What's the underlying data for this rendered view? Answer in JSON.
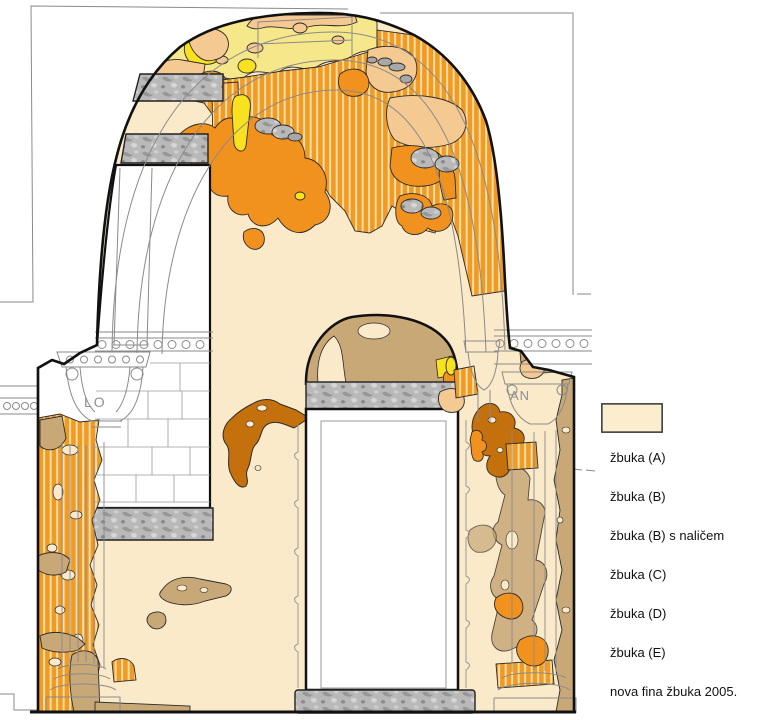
{
  "drawing": {
    "inscriptions": {
      "left_capital": "LO",
      "right_capital": "AN"
    }
  },
  "palette": {
    "kamen_gray": "#B8B8B8",
    "zbuka_a": "#F5C992",
    "zbuka_b": "#F2921E",
    "zbuka_b_stripe": "#FBE0AE",
    "zbuka_c": "#F8E11E",
    "zbuka_c_pale": "#F6E88A",
    "zbuka_d": "#C9A878",
    "zbuka_e": "#C4700D",
    "nova_fina": "#FAEACA",
    "outline_black": "#1a1a1a",
    "line_gray": "#8a8a8a"
  },
  "legend": {
    "items": [
      {
        "id": "kamen",
        "label": "kamen",
        "type": "stone-texture",
        "color": "#B8B8B8"
      },
      {
        "id": "zbuka-a",
        "label": "žbuka (A)",
        "type": "solid",
        "color": "#F5C992"
      },
      {
        "id": "zbuka-b",
        "label": "žbuka (B)",
        "type": "solid",
        "color": "#F2921E"
      },
      {
        "id": "zbuka-b-nal",
        "label": "žbuka (B) s naličem",
        "type": "striped",
        "color": "#F2921E",
        "stripe_color": "#FDF2DC"
      },
      {
        "id": "zbuka-c",
        "label": "žbuka (C)",
        "type": "solid",
        "color": "#F8E11E"
      },
      {
        "id": "zbuka-d",
        "label": "žbuka (D)",
        "type": "solid",
        "color": "#C9A878"
      },
      {
        "id": "zbuka-e",
        "label": "žbuka (E)",
        "type": "solid",
        "color": "#C4700D"
      },
      {
        "id": "nova-fina",
        "label": "nova fina žbuka 2005.",
        "type": "solid",
        "color": "#FBEDCD"
      }
    ]
  }
}
